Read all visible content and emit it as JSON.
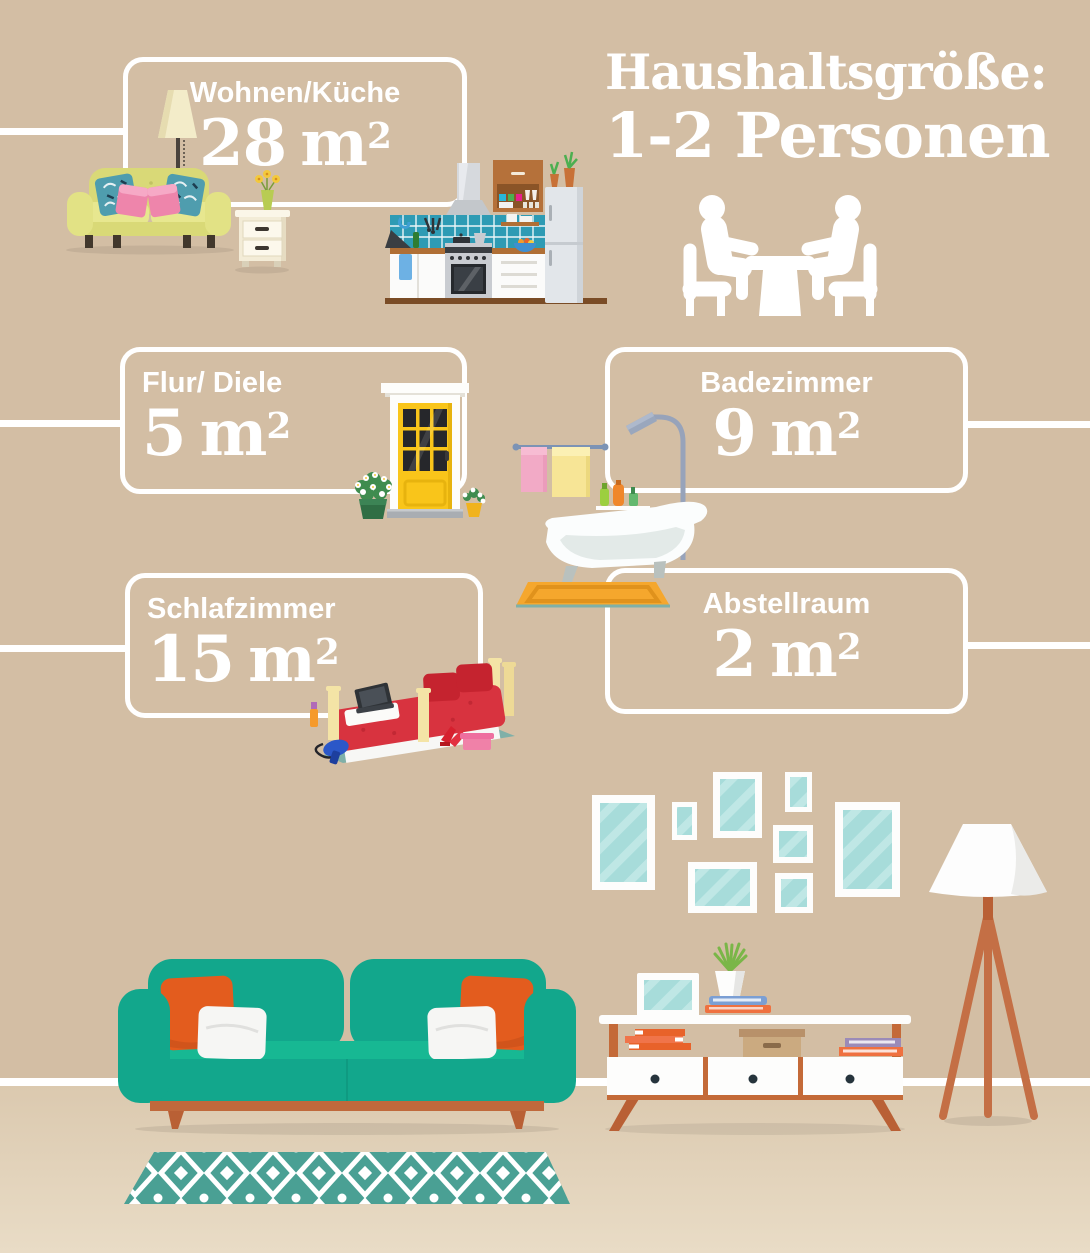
{
  "title": {
    "line1": "Haushaltsgröße:",
    "line2": "1-2 Personen"
  },
  "rooms": [
    {
      "id": "wohnen-kueche",
      "label": "Wohnen/Küche",
      "value": "28",
      "unit": "m",
      "exponent": "2"
    },
    {
      "id": "flur-diele",
      "label": "Flur/ Diele",
      "value": "5",
      "unit": "m",
      "exponent": "2"
    },
    {
      "id": "badezimmer",
      "label": "Badezimmer",
      "value": "9",
      "unit": "m",
      "exponent": "2"
    },
    {
      "id": "schlafzimmer",
      "label": "Schlafzimmer",
      "value": "15",
      "unit": "m",
      "exponent": "2"
    },
    {
      "id": "abstellraum",
      "label": "Abstellraum",
      "value": "2",
      "unit": "m",
      "exponent": "2"
    }
  ],
  "icons": {
    "people-at-table-icon": "two persons seated at a dining table",
    "living-room-set-illustration": "yellow-green sofa, floor lamp, nightstand with flowers",
    "kitchen-illustration": "kitchen with hood, stove, tiles, cabinet, fridge",
    "front-door-illustration": "yellow front door with flower pots",
    "bathroom-illustration": "clawfoot tub, shower, towels, bath mat",
    "bedroom-illustration": "red bed with laptop, hair dryer, shoes",
    "gallery-frames-illustration": "wall of empty picture frames",
    "tripod-floor-lamp-illustration": "white shade tripod lamp",
    "sideboard-illustration": "white sideboard with books, box and plant",
    "teal-sofa-illustration": "teal sofa with orange and white pillows",
    "rug-illustration": "teal diamond-pattern rug"
  },
  "colors": {
    "wall": "#d3bea4",
    "floor": "#dbc9af",
    "line": "#ffffff",
    "text": "#ffffff",
    "sofa_teal": "#12a78c",
    "pillow_orange": "#e35c1e",
    "wood_terracotta": "#c46a38",
    "rug_teal": "#4aa094",
    "frame_glass": "#a7dcda",
    "door_yellow": "#f9c51a",
    "bed_red": "#d8333f",
    "sofa_yellow_green": "#dcdc7e",
    "mat_orange": "#f5a72d",
    "tile_teal": "#2e9bb4"
  }
}
